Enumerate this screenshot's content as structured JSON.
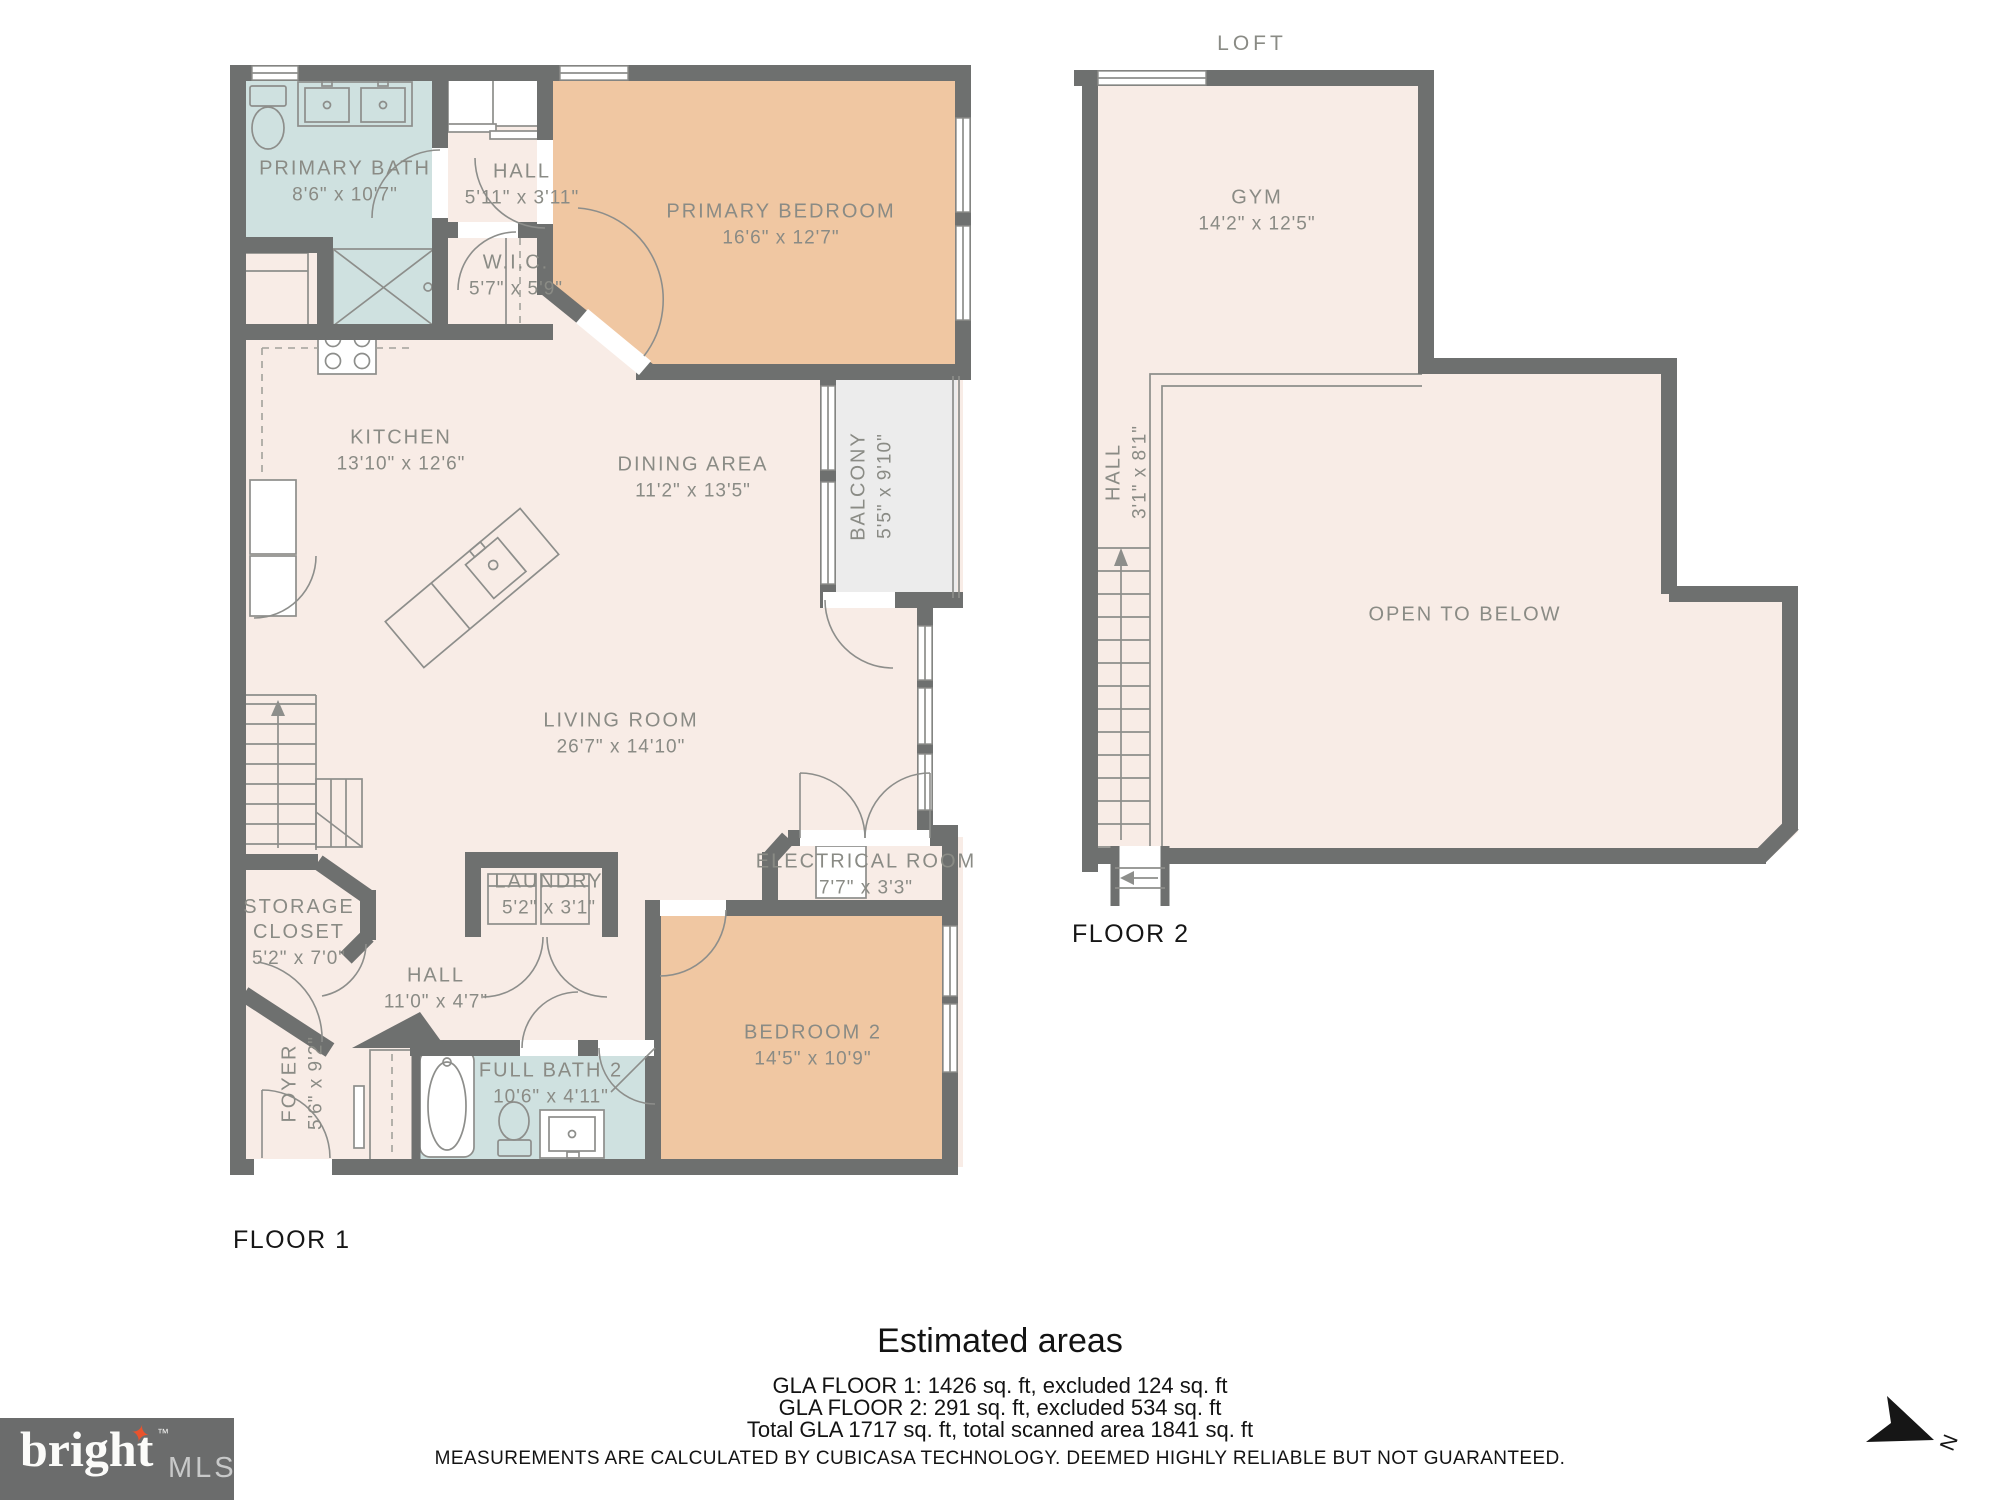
{
  "colors": {
    "wall": "#6e706f",
    "floor": "#f8ece6",
    "bedroom": "#f0c7a2",
    "bath": "#cfe1e0",
    "balcony": "#ececec",
    "label": "#8a8b85",
    "ink": "#1d1d1b",
    "logo_bg": "#6b6c6c",
    "logo_star": "#e8532d",
    "logo_mls": "#c8c9c9"
  },
  "floor1": {
    "label": "FLOOR 1",
    "rooms": {
      "primary_bath": {
        "name": "PRIMARY BATH",
        "dims": "8'6\" x 10'7\""
      },
      "hall_top": {
        "name": "HALL",
        "dims": "5'11\" x 3'11\""
      },
      "wic": {
        "name": "W.I.C.",
        "dims": "5'7\" x 5'9\""
      },
      "primary_bedroom": {
        "name": "PRIMARY BEDROOM",
        "dims": "16'6\" x 12'7\""
      },
      "kitchen": {
        "name": "KITCHEN",
        "dims": "13'10\" x 12'6\""
      },
      "dining": {
        "name": "DINING AREA",
        "dims": "11'2\" x 13'5\""
      },
      "balcony": {
        "name": "BALCONY",
        "dims": "5'5\" x 9'10\""
      },
      "living": {
        "name": "LIVING ROOM",
        "dims": "26'7\" x 14'10\""
      },
      "storage": {
        "name": "STORAGE CLOSET",
        "dims": "5'2\" x 7'0\""
      },
      "laundry": {
        "name": "LAUNDRY",
        "dims": "5'2\" x 3'1\""
      },
      "electrical": {
        "name": "ELECTRICAL ROOM",
        "dims": "7'7\" x 3'3\""
      },
      "hall_bottom": {
        "name": "HALL",
        "dims": "11'0\" x 4'7\""
      },
      "foyer": {
        "name": "FOYER",
        "dims": "5'6\" x 9'2\""
      },
      "full_bath_2": {
        "name": "FULL BATH 2",
        "dims": "10'6\" x 4'11\""
      },
      "bedroom_2": {
        "name": "BEDROOM 2",
        "dims": "14'5\" x 10'9\""
      }
    }
  },
  "floor2": {
    "label": "FLOOR 2",
    "title": "LOFT",
    "rooms": {
      "gym": {
        "name": "GYM",
        "dims": "14'2\" x 12'5\""
      },
      "hall": {
        "name": "HALL",
        "dims": "3'1\" x 8'1\""
      },
      "open_to_below": {
        "name": "OPEN TO BELOW"
      }
    }
  },
  "summary": {
    "title": "Estimated areas",
    "line1": "GLA FLOOR 1: 1426 sq. ft, excluded 124 sq. ft",
    "line2": "GLA FLOOR 2: 291 sq. ft, excluded 534 sq. ft",
    "line3": "Total GLA 1717 sq. ft, total scanned area 1841 sq. ft",
    "disclaimer": "MEASUREMENTS ARE CALCULATED BY CUBICASA TECHNOLOGY. DEEMED HIGHLY RELIABLE BUT NOT GUARANTEED."
  },
  "branding": {
    "logo_word": "bright",
    "logo_tm": "™",
    "logo_suffix": "MLS"
  },
  "compass": {
    "label": "N"
  }
}
